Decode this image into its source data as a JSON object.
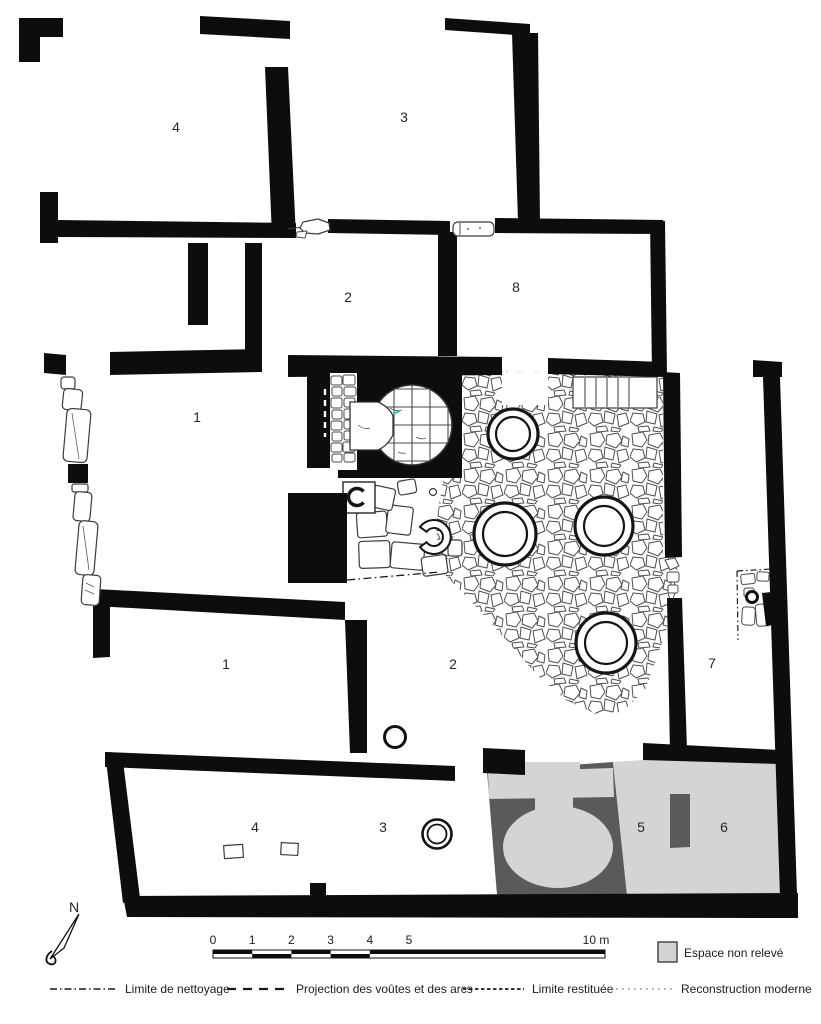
{
  "rooms": [
    {
      "id": "room-4-top",
      "label": "4"
    },
    {
      "id": "room-3-top",
      "label": "3"
    },
    {
      "id": "room-2-top",
      "label": "2"
    },
    {
      "id": "room-8",
      "label": "8"
    },
    {
      "id": "room-1-upper",
      "label": "1"
    },
    {
      "id": "room-1-lower",
      "label": "1"
    },
    {
      "id": "room-2-lower",
      "label": "2"
    },
    {
      "id": "room-7",
      "label": "7"
    },
    {
      "id": "room-4-bottom",
      "label": "4"
    },
    {
      "id": "room-3-bottom",
      "label": "3"
    },
    {
      "id": "room-5",
      "label": "5"
    },
    {
      "id": "room-6",
      "label": "6"
    }
  ],
  "north": {
    "label": "N"
  },
  "scale_bar": {
    "ticks": [
      "0",
      "1",
      "2",
      "3",
      "4",
      "5"
    ],
    "end_label": "10 m"
  },
  "legend": {
    "area_item": {
      "label": "Espace non relevé",
      "swatch_color": "#d3d4d6"
    },
    "line_items": [
      {
        "label": "Limite de nettoyage",
        "style": "dash-dot"
      },
      {
        "label": "Projection des voûtes et des arcs",
        "style": "dashed"
      },
      {
        "label": "Limite restituée",
        "style": "small-dashes"
      },
      {
        "label": "Reconstruction moderne",
        "style": "dotted"
      }
    ]
  },
  "colors": {
    "wall_black": "#0d0d0d",
    "dark_gray": "#595a5c",
    "light_gray": "#d3d4d6",
    "teal_mark": "#2fc3c1"
  }
}
